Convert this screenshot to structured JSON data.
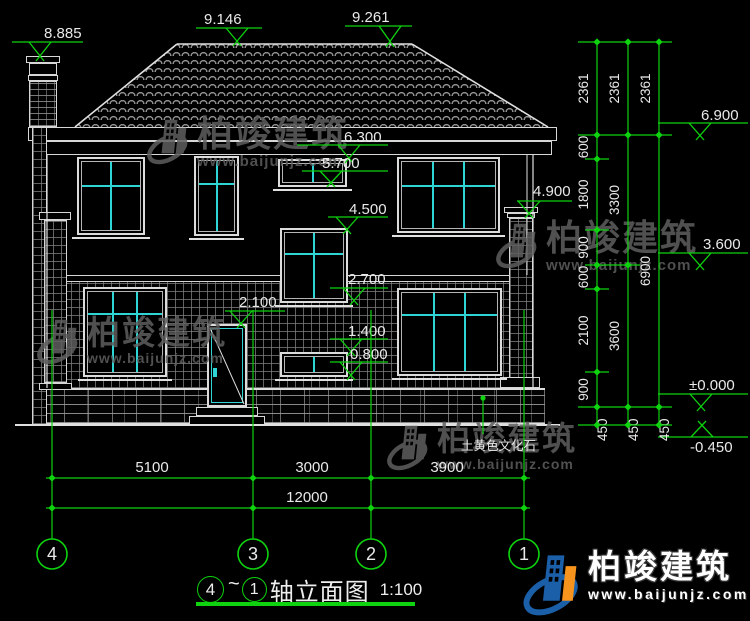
{
  "watermark": {
    "brand": "柏竣建筑",
    "url": "www.baijunjz.com"
  },
  "logo": {
    "brand": "柏竣建筑",
    "url": "www.baijunjz.com"
  },
  "title": {
    "axis_from": "4",
    "tilde": "~",
    "axis_to": "1",
    "name": "轴立面图",
    "scale": "1:100"
  },
  "axes": [
    "4",
    "3",
    "2",
    "1"
  ],
  "elevation_markers": [
    "8.885",
    "9.146",
    "9.261",
    "6.300",
    "5.700",
    "4.500",
    "2.700",
    "2.100",
    "1.400",
    "0.800",
    "4.900",
    "6.900",
    "3.600",
    "±0.000",
    "-0.450"
  ],
  "right_dim_chains": [
    [
      "2361",
      "600",
      "1800",
      "900",
      "600",
      "2100",
      "900",
      "450"
    ],
    [
      "2361",
      "3300",
      "3600",
      "450"
    ],
    [
      "2361",
      "6900",
      "450"
    ]
  ],
  "bottom_dims": {
    "row1": [
      "5100",
      "3000",
      "3900"
    ],
    "row2": [
      "12000"
    ]
  },
  "material_label": "土黄色文化石",
  "colors": {
    "cad_green": "#0ed30e",
    "cad_cyan": "#2fd4d4",
    "line_white": "#e0e0e0",
    "watermark_gray": "#5f5f5f",
    "logo_blue": "#1a5fa8",
    "logo_orange": "#f7941d"
  }
}
